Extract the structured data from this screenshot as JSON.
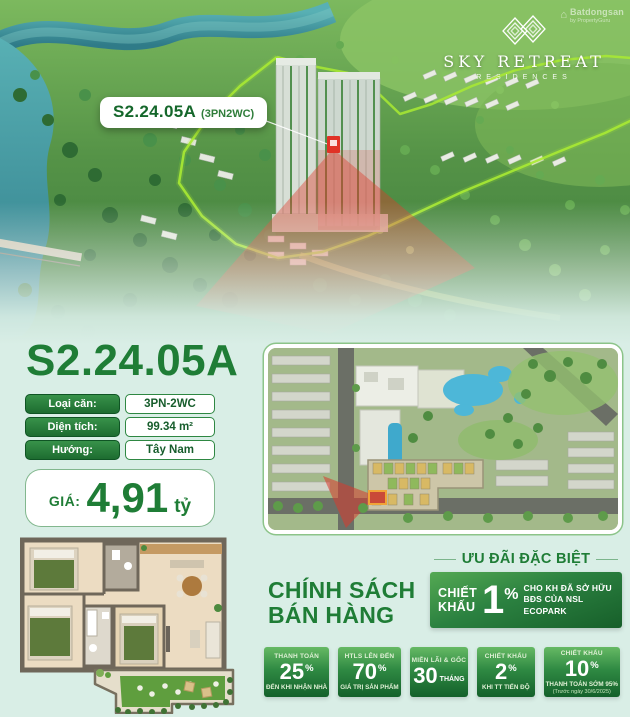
{
  "watermark": {
    "line1": "Batdongsan",
    "line2": "by PropertyGuru"
  },
  "logo": {
    "title": "SKY RETREAT",
    "subtitle": "RESIDENCES"
  },
  "photo": {
    "label_code": "S2.24.05A",
    "label_type": "(3PN2WC)"
  },
  "unit": {
    "title": "S2.24.05A",
    "specs": [
      {
        "label": "Loại căn:",
        "value": "3PN-2WC"
      },
      {
        "label": "Diện tích:",
        "value": "99.34 m²"
      },
      {
        "label": "Hướng:",
        "value": "Tây Nam"
      }
    ],
    "price": {
      "label": "GIÁ:",
      "value": "4,91",
      "unit": "tỷ"
    }
  },
  "policy": {
    "line1": "CHÍNH SÁCH",
    "line2": "BÁN HÀNG"
  },
  "offer": {
    "title": "ƯU ĐÃI ĐẶC BIỆT",
    "word1": "CHIẾT",
    "word2": "KHẤU",
    "percent": "1",
    "sign": "%",
    "desc1": "CHO KH ĐÃ SỞ HỮU",
    "desc2": "BĐS CỦA NSL ECOPARK"
  },
  "badges": [
    {
      "top": "THANH TOÁN",
      "value": "25",
      "suffix": "%",
      "bottom": "ĐẾN KHI NHẬN NHÀ"
    },
    {
      "top": "HTLS LÊN ĐẾN",
      "value": "70",
      "suffix": "%",
      "bottom": "GIÁ TRỊ SẢN PHẨM"
    },
    {
      "top": "MIỄN LÃI & GỐC",
      "value": "30",
      "suffix": "THÁNG",
      "bottom": ""
    },
    {
      "top": "CHIẾT KHẤU",
      "value": "2",
      "suffix": "%",
      "bottom": "KHI TT TIẾN ĐỘ"
    },
    {
      "top": "CHIẾT KHẤU",
      "value": "10",
      "suffix": "%",
      "bottom": "THANH TOÁN SỚM 95%",
      "note": "(Trước ngày 30/6/2025)"
    }
  ],
  "colors": {
    "primary_green": "#1f7d36",
    "dark_green": "#14602a",
    "mint_background": "#d9eee6",
    "boundary_green": "#a9ea33",
    "highlight_red": "#dd3b2c",
    "pool_blue": "#4db7d8"
  }
}
